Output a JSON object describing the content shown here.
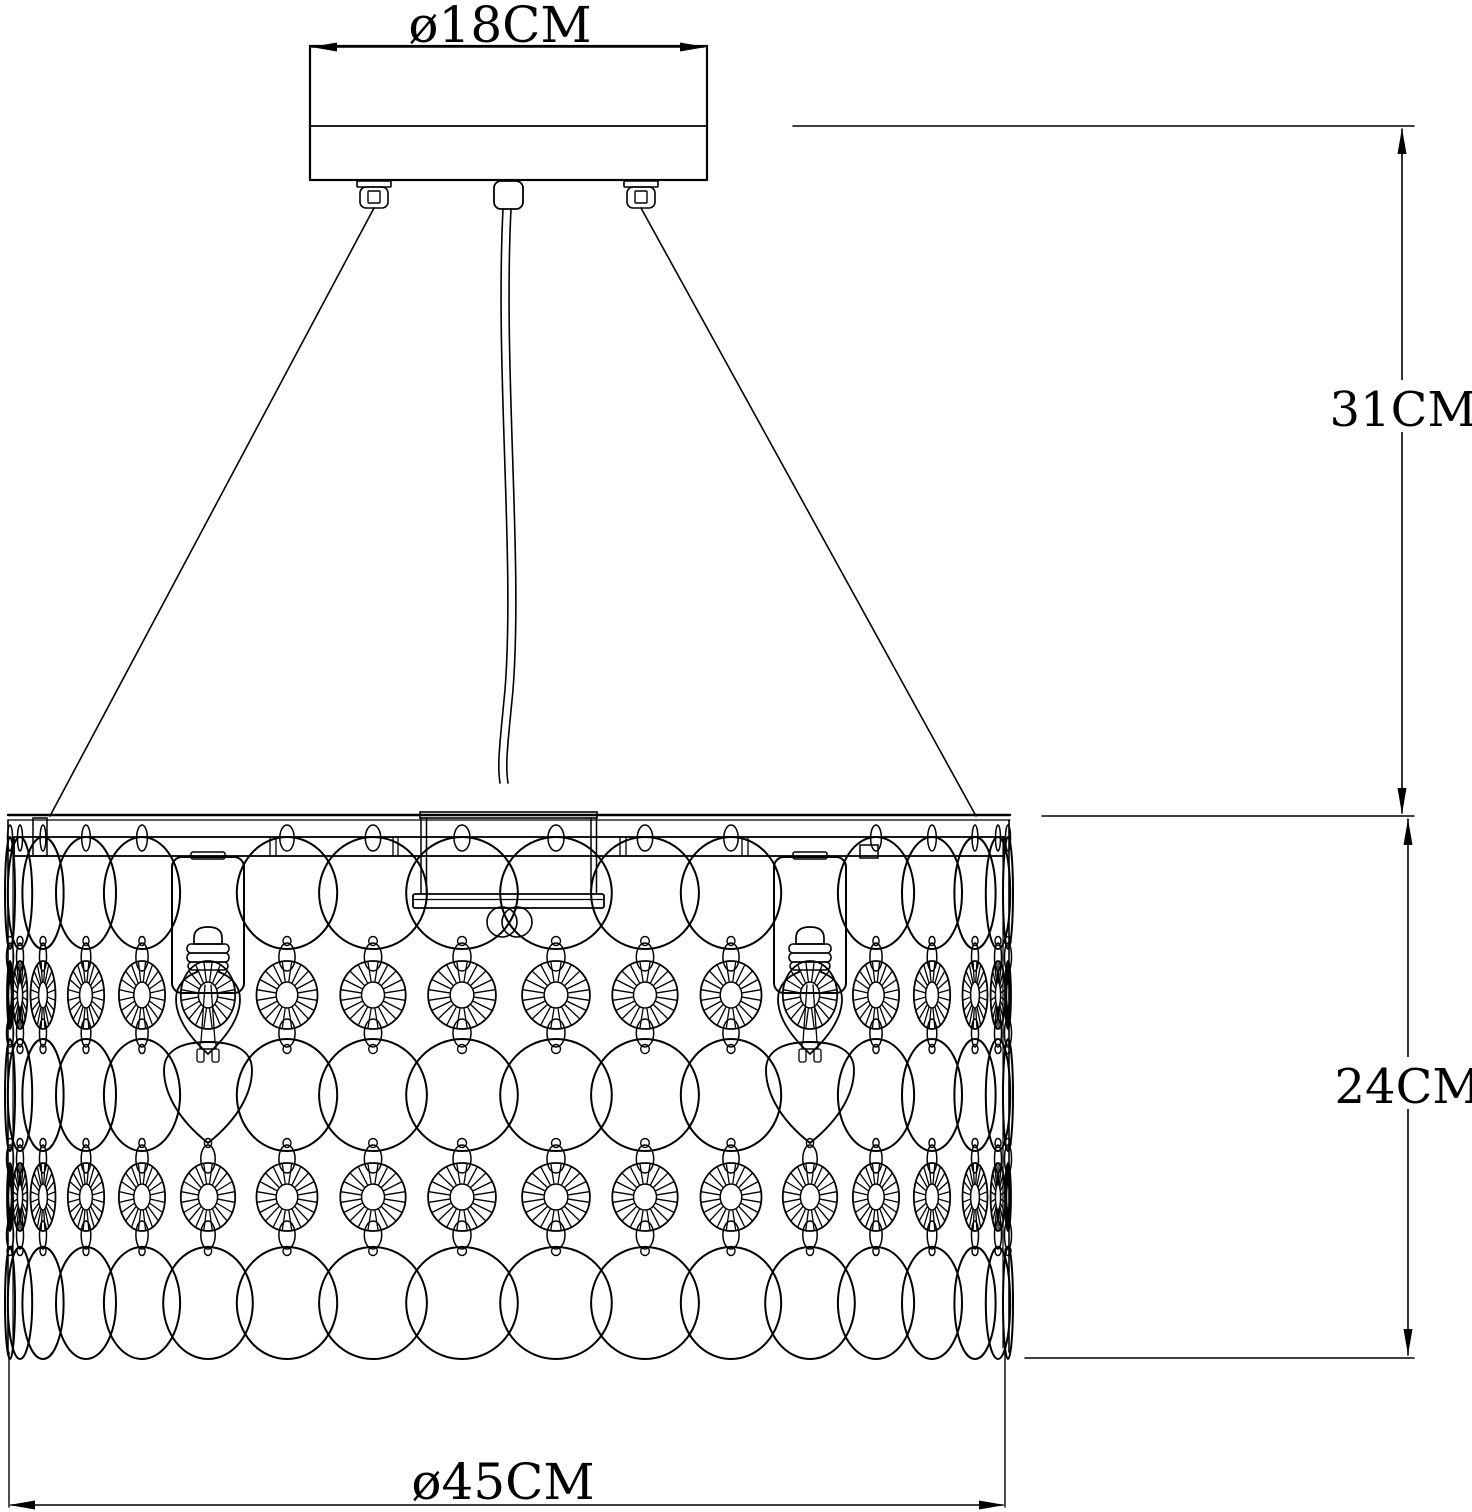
{
  "figure": {
    "drawing_type": "pendant-lamp-dimension-drawing",
    "dimensions": [
      {
        "id": "canopy-diameter",
        "label": "ø18CM",
        "value_cm": 18
      },
      {
        "id": "hanging-drop",
        "label": "31CM",
        "value_cm": 31
      },
      {
        "id": "shade-height",
        "label": "24CM",
        "value_cm": 24
      },
      {
        "id": "shade-diameter",
        "label": "ø45CM",
        "value_cm": 45
      }
    ],
    "components": [
      "ceiling-canopy",
      "canopy-screws",
      "power-cord",
      "suspension-wires",
      "drum-shade-rail",
      "crystal-disc-columns",
      "starburst-discs",
      "bulb-sockets",
      "candle-bulbs",
      "teardrop-crystals",
      "center-hub"
    ]
  },
  "colors": {
    "line": "#000000",
    "background": "#ffffff"
  }
}
